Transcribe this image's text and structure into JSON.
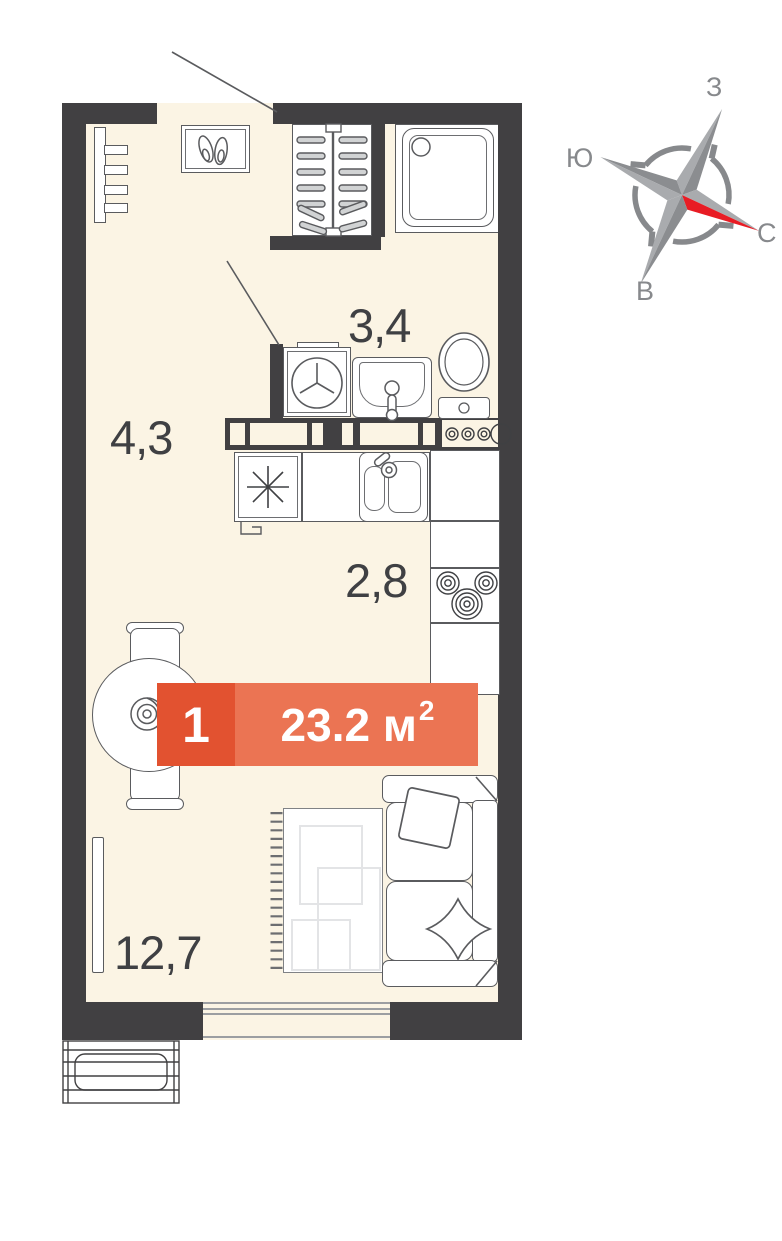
{
  "plan": {
    "rooms": {
      "hallway": {
        "area_label": "4,3"
      },
      "bathroom": {
        "area_label": "3,4"
      },
      "kitchen": {
        "area_label": "2,8"
      },
      "living": {
        "area_label": "12,7"
      }
    },
    "badge": {
      "room_count": "1",
      "area_value": "23.2 м",
      "area_sup": "2"
    },
    "fixtures": [
      "wardrobe-hangers",
      "shoe-cabinet",
      "coat-hooks",
      "shower",
      "washing-machine",
      "washbasin",
      "toilet",
      "kitchen-sink",
      "refrigerator",
      "hob",
      "meter-box",
      "dining-table",
      "chair",
      "vase",
      "tv",
      "rug",
      "sofa",
      "pillow",
      "window",
      "ac-basket"
    ],
    "colors": {
      "wall": "#414042",
      "floor": "#FBF4E4",
      "line": "#5a5b5e",
      "badge_primary": "#E25230",
      "badge_secondary": "#EB7453",
      "compass_red": "#E81C24",
      "compass_gray": "#87898c"
    }
  },
  "compass": {
    "top": "З",
    "left": "Ю",
    "right": "С",
    "bottom": "В"
  }
}
